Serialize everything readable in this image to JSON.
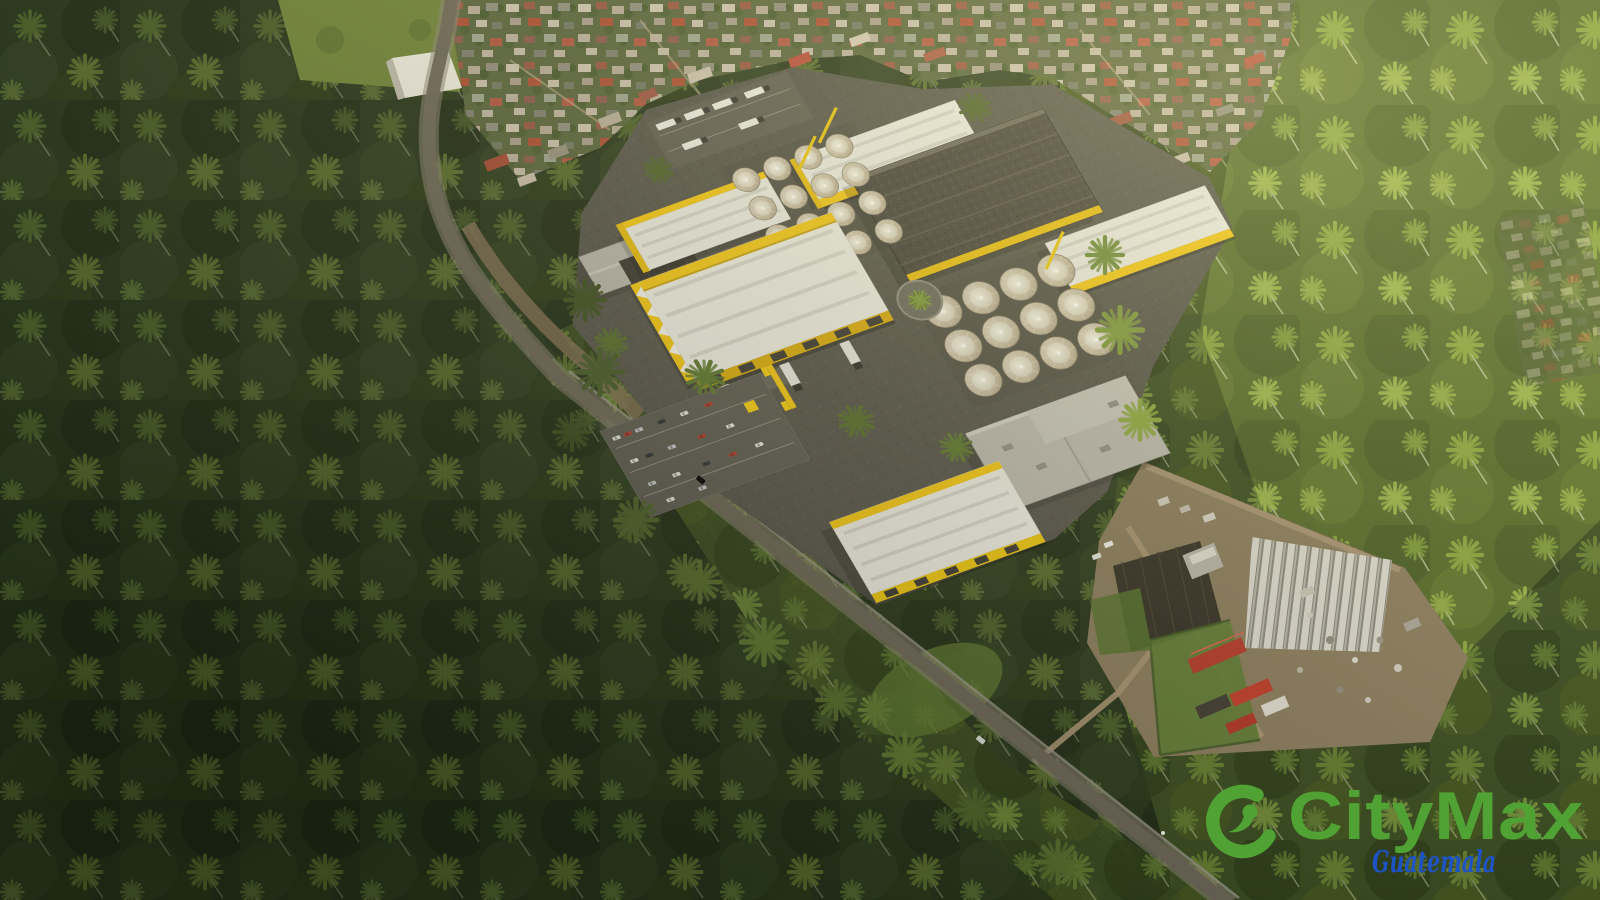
{
  "watermark": {
    "brand": "CityMax",
    "region": "Guatemala",
    "brand_color": "#4fa233",
    "region_color": "#1d53c4",
    "icon": "citymax-swoosh-icon"
  },
  "palette": {
    "forest_dark": "#26331b",
    "forest_mid": "#394a21",
    "forest_light": "#556a2b",
    "palm_frond_light": "#8ba33f",
    "warehouse_yellow": "#f2c414",
    "warehouse_roof_white": "#e9e7df",
    "industrial_dark_roof": "#45403a",
    "silo_beige": "#c9bca6",
    "asphalt_road": "#6b6457",
    "farm_dirt": "#8a7a5d",
    "farm_shed_red": "#b5382a",
    "village_roof_red": "#a14733",
    "village_roof_light": "#c5bbaa"
  },
  "scene": {
    "type": "aerial-render",
    "subject": "Aerial view of a yellow-and-white industrial warehouse complex with grain silos, set in coconut palm plantations; village to the north, nursery farm with greenhouses and red sheds to the southeast, a highway crossing diagonally",
    "elements": [
      "palm-plantation",
      "village",
      "highway",
      "warehouse-complex",
      "silo-groups",
      "parking-lots",
      "entrance-gate",
      "farm-nursery",
      "greenhouses",
      "watermark-logo"
    ]
  }
}
